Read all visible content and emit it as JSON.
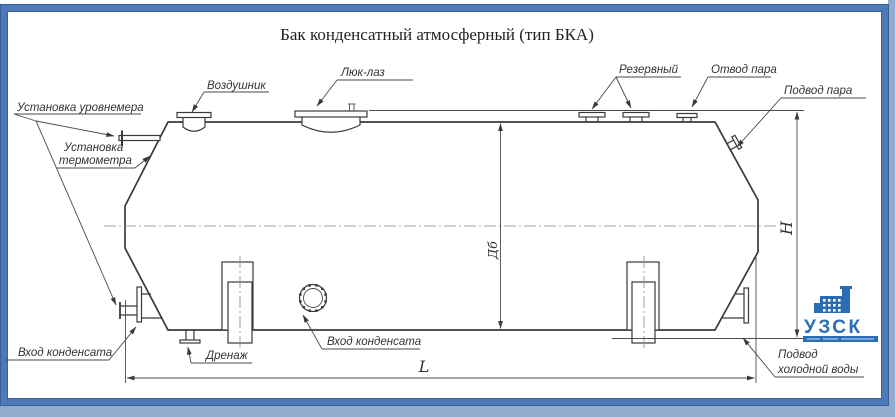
{
  "drawing": {
    "title": "Бак конденсатный атмосферный (тип БКА)",
    "callouts": {
      "air_vent": "Воздушник",
      "manhole": "Люк-лаз",
      "reserve": "Резервный",
      "steam_outlet": "Отвод пара",
      "steam_supply": "Подвод пара",
      "level_gauge": "Установка уровнемера",
      "thermometer_line1": "Установка",
      "thermometer_line2": "термометра",
      "condensate_inlet_left": "Вход конденсата",
      "drain": "Дренаж",
      "condensate_inlet_center": "Вход конденсата",
      "cold_water_line1": "Подвод",
      "cold_water_line2": "холодной воды"
    },
    "dimension_labels": {
      "diameter": "Дб",
      "height": "H",
      "length": "L"
    }
  },
  "logo": {
    "text": "УЗСК",
    "color": "#2a6cb5"
  },
  "colors": {
    "frame": "#4d7ab6",
    "frame_edge": "#3a6095",
    "line": "#3a3a3a"
  }
}
